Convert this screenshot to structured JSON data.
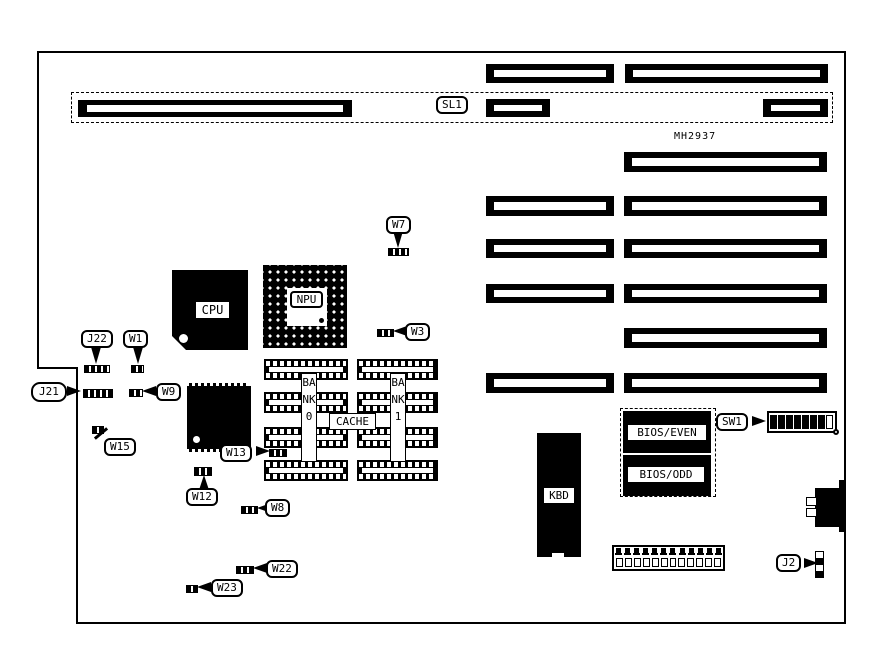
{
  "board": {
    "silkscreen_label": "MH2937",
    "chips": {
      "cpu": "CPU",
      "npu": "NPU",
      "kbd": "KBD",
      "bios_even": "BIOS/EVEN",
      "bios_odd": "BIOS/ODD"
    },
    "memory": {
      "bank0": "BANK0",
      "bank1": "BANK1",
      "cache": "CACHE"
    },
    "callouts": {
      "sl1": "SL1",
      "w7": "W7",
      "w3": "W3",
      "j22": "J22",
      "w1": "W1",
      "j21": "J21",
      "w9": "W9",
      "w15": "W15",
      "w13": "W13",
      "w12": "W12",
      "w8": "W8",
      "w22": "W22",
      "w23": "W23",
      "sw1": "SW1",
      "j2": "J2"
    },
    "sw1_segments_total": 8,
    "sw1_segments_on": 7,
    "j2_pins": 4,
    "power_connector_pins": 12
  }
}
